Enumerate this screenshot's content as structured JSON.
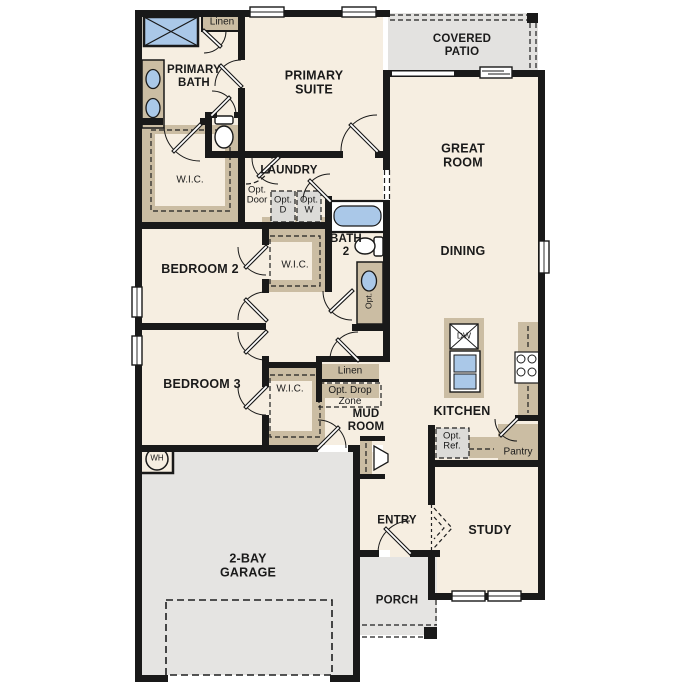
{
  "plan_title": "Single-story floor plan",
  "labels": {
    "linen_top": "Linen",
    "primary_bath": "PRIMARY\nBATH",
    "primary_suite": "PRIMARY\nSUITE",
    "covered_patio": "COVERED\nPATIO",
    "great_room": "GREAT\nROOM",
    "wic_primary": "W.I.C.",
    "laundry": "LAUNDRY",
    "opt_door": "Opt.\nDoor",
    "opt_dryer": "Opt.\nD",
    "opt_washer": "Opt.\nW",
    "bath2": "BATH\n2",
    "opt_vanity": "Opt.",
    "dining": "DINING",
    "bedroom2": "BEDROOM 2",
    "wic_bed2": "W.I.C.",
    "bedroom3": "BEDROOM 3",
    "wic_bed3": "W.I.C.",
    "linen_hall": "Linen",
    "opt_drop_zone": "Opt. Drop\nZone",
    "mud_room": "MUD\nROOM",
    "kitchen": "KITCHEN",
    "dishwasher": "DW",
    "opt_ref": "Opt.\nRef.",
    "pantry": "Pantry",
    "study": "STUDY",
    "entry": "ENTRY",
    "garage": "2-BAY\nGARAGE",
    "water_heater": "WH",
    "porch": "PORCH"
  },
  "colors": {
    "wall": "#191919",
    "floor": "#f6eee1",
    "exterior_concrete": "#e5e4e2",
    "casework_tan": "#cbbda3",
    "fixture_blue": "#aac8e8",
    "optional_gray": "#dcdbd8"
  }
}
